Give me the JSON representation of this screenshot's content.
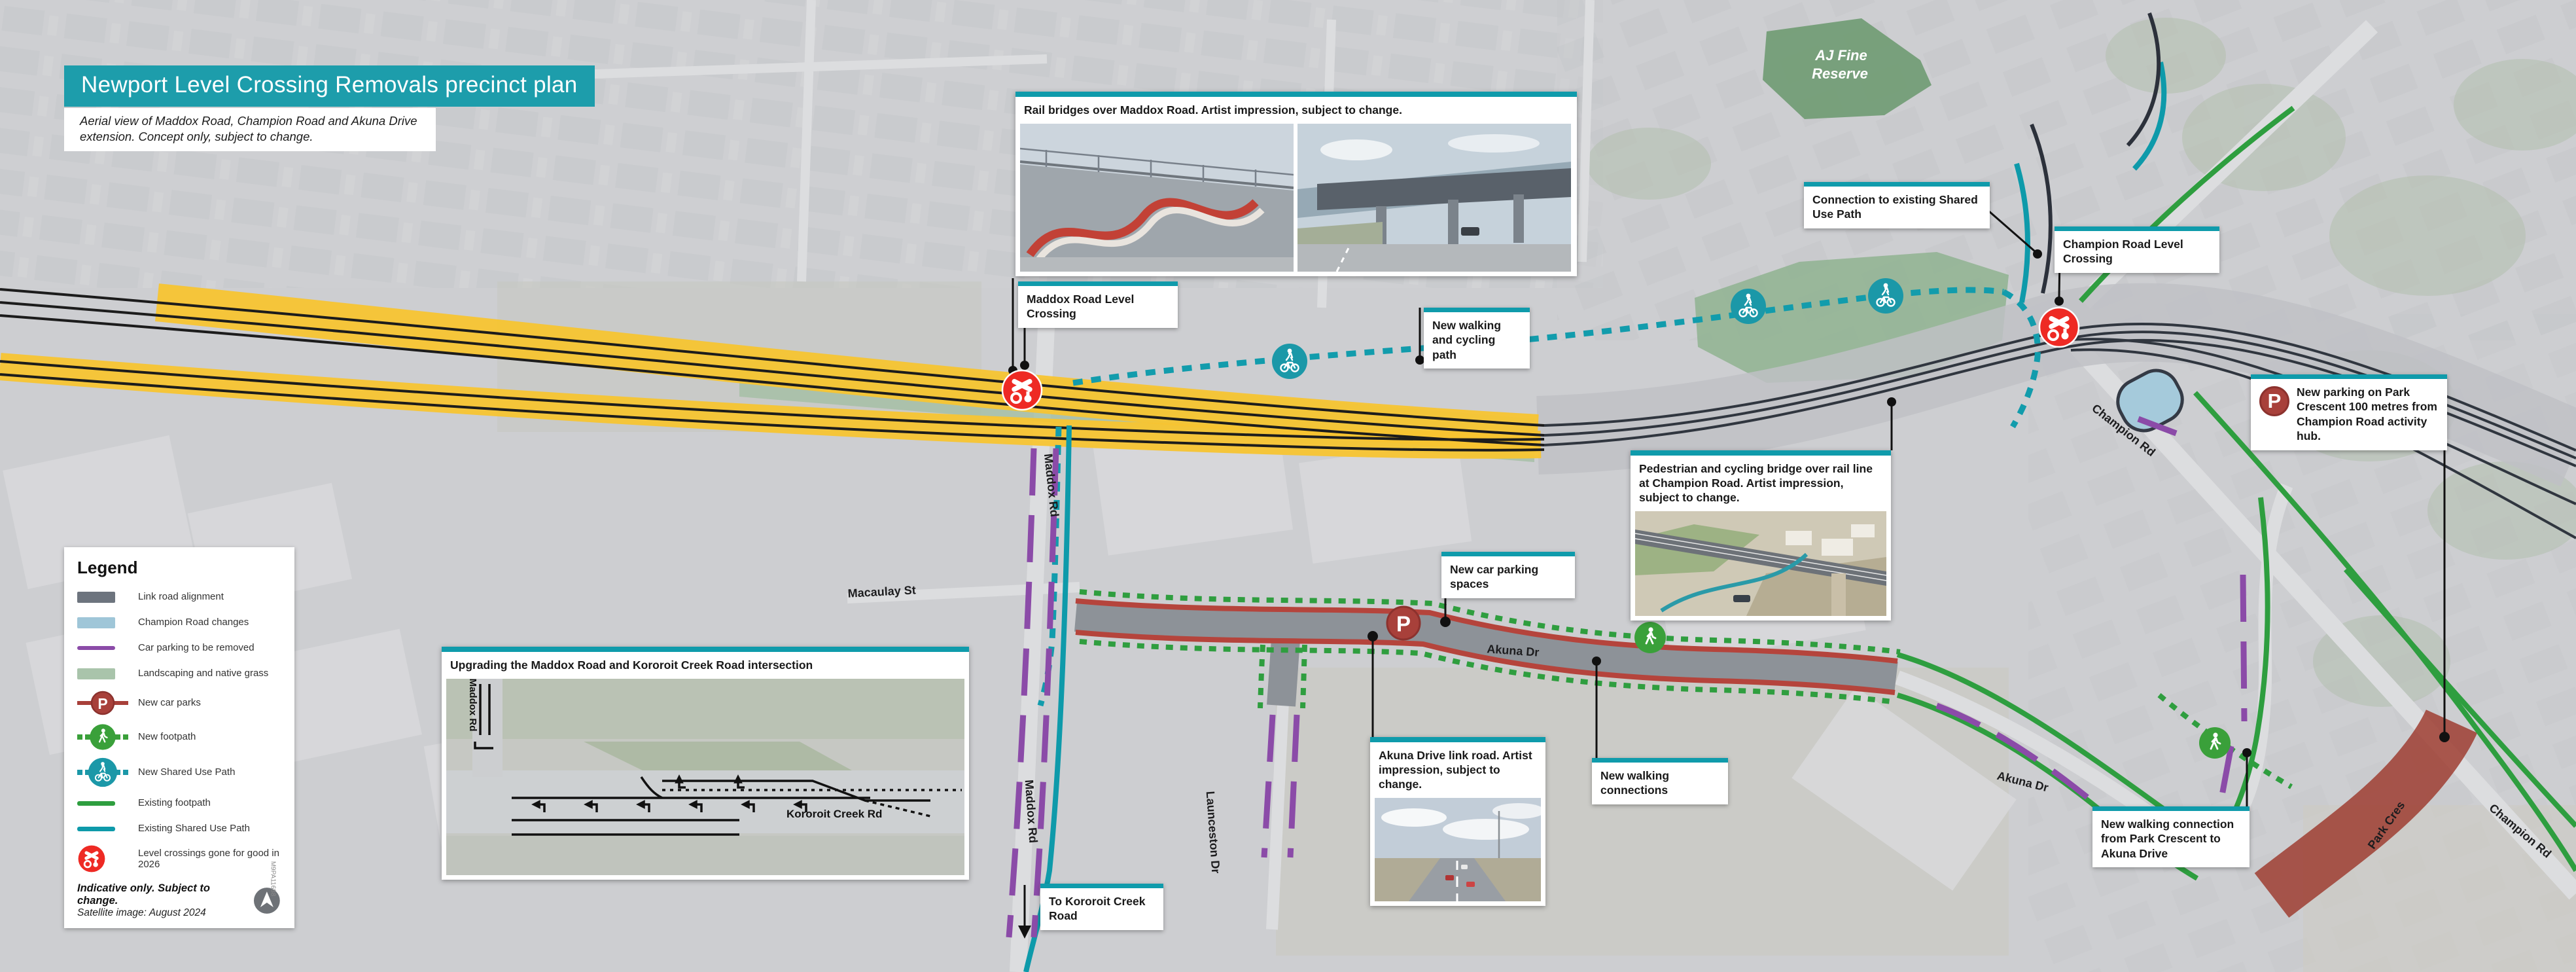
{
  "header": {
    "title": "Newport Level Crossing Removals precinct plan",
    "subtitle": "Aerial view of Maddox Road, Champion Road and Akuna Drive extension. Concept only, subject to change."
  },
  "legend": {
    "heading": "Legend",
    "items": [
      {
        "label": "Link road alignment",
        "color": "#6d747e"
      },
      {
        "label": "Champion Road changes",
        "color": "#9fc6d8"
      },
      {
        "label": "Car parking to be removed",
        "color": "#8b4ba8"
      },
      {
        "label": "Landscaping and native grass",
        "color": "#a9c4ab"
      },
      {
        "label": "New car parks",
        "color": "#a8403a"
      },
      {
        "label": "New footpath",
        "color": "#3aa03a"
      },
      {
        "label": "New Shared Use Path",
        "color": "#1b98a8"
      },
      {
        "label": "Existing footpath",
        "color": "#2e9e3f"
      },
      {
        "label": "Existing Shared Use Path",
        "color": "#0e9aaa"
      },
      {
        "label": "Level crossings gone for good in 2026",
        "color": "#ee2a24"
      }
    ],
    "note_bold": "Indicative only. Subject to change.",
    "note": "Satellite image: August 2024",
    "ref_code": "M9PA11688"
  },
  "callouts": {
    "rail_bridges": "Rail bridges over Maddox Road. Artist impression, subject to change.",
    "maddox_crossing": "Maddox Road Level Crossing",
    "walking_cycling": "New walking and cycling path",
    "connection_sup": "Connection to existing Shared Use Path",
    "champion_crossing": "Champion Road Level Crossing",
    "new_parking": "New parking on Park Crescent 100 metres from Champion Road activity hub.",
    "ped_bridge": "Pedestrian and cycling bridge over rail line at Champion Road. Artist impression, subject to change.",
    "car_spaces": "New car parking spaces",
    "intersection": "Upgrading the Maddox Road and Kororoit Creek Road intersection",
    "akuna": "Akuna Drive link road. Artist impression, subject to change.",
    "walking_connections": "New walking connections",
    "walking_park_cres": "New walking connection from Park Crescent to Akuna Drive",
    "to_kororoit": "To Kororoit Creek Road"
  },
  "map_labels": {
    "maddox_rd_upper": "Maddox Rd",
    "maddox_rd_lower": "Maddox Rd",
    "macaulay_st": "Macaulay St",
    "launceston_dr": "Launceston Dr",
    "akuna_dr_link": "Akuna Dr",
    "akuna_dr_east": "Akuna Dr",
    "champion_rd_upper": "Champion Rd",
    "champion_rd_lower": "Champion Rd",
    "park_cres": "Park Cres",
    "reserve_line1": "AJ Fine",
    "reserve_line2": "Reserve"
  },
  "inset": {
    "maddox_rd": "Maddox Rd",
    "kororoit_creek_rd": "Kororoit Creek Rd"
  },
  "colors": {
    "brand_teal": "#1d9dab",
    "callout_teal": "#0f9bab",
    "rail_yellow": "#f7c431",
    "crossing_red": "#ee2a24",
    "car_park_red": "#a8403a",
    "footpath_green": "#2e9e3f",
    "sup_teal": "#0e9aaa",
    "parking_purple": "#8b4ba8",
    "landscape_green": "#a3bfa3",
    "link_road_grey": "#6d747e",
    "champion_blue": "#9fc6d8",
    "park_cres_red": "#9c382c"
  }
}
